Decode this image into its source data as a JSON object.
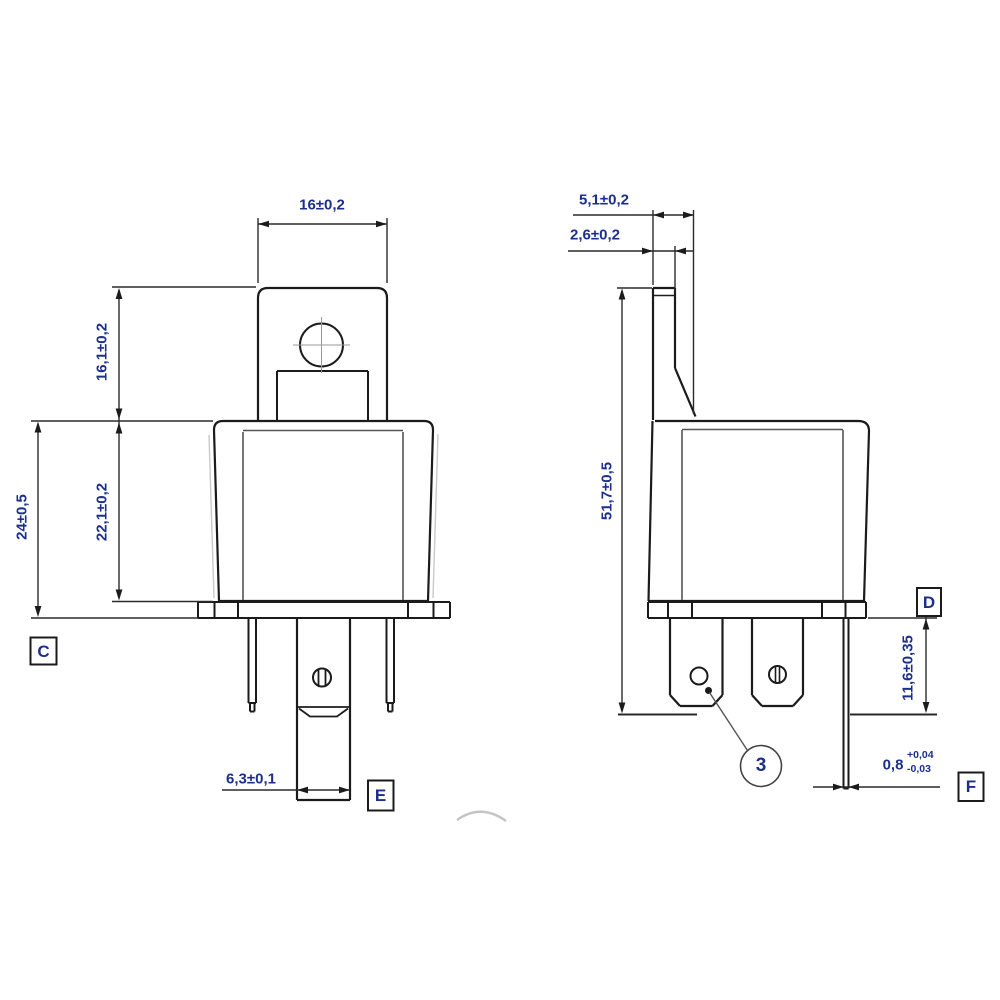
{
  "front_view": {
    "dim_bracket_width": "16±0,2",
    "dim_bracket_height": "16,1±0,2",
    "dim_body_height": "22,1±0,2",
    "dim_overall_height": "24±0,5",
    "dim_pin_width": "6,3±0,1",
    "label_c": "C",
    "label_e": "E"
  },
  "side_view": {
    "dim_bracket_depth": "5,1±0,2",
    "dim_bracket_thickness": "2,6±0,2",
    "dim_overall_height": "51,7±0,5",
    "dim_pin_length": "11,6±0,35",
    "dim_pin_thickness": "0,8",
    "dim_pin_thickness_tol_upper": "+0,04",
    "dim_pin_thickness_tol_lower": "-0,03",
    "label_d": "D",
    "label_f": "F",
    "balloon_item": "3"
  },
  "colors": {
    "line": "#1b1b1b",
    "dimension_text": "#1c2f8d",
    "secondary_line": "#555555"
  }
}
